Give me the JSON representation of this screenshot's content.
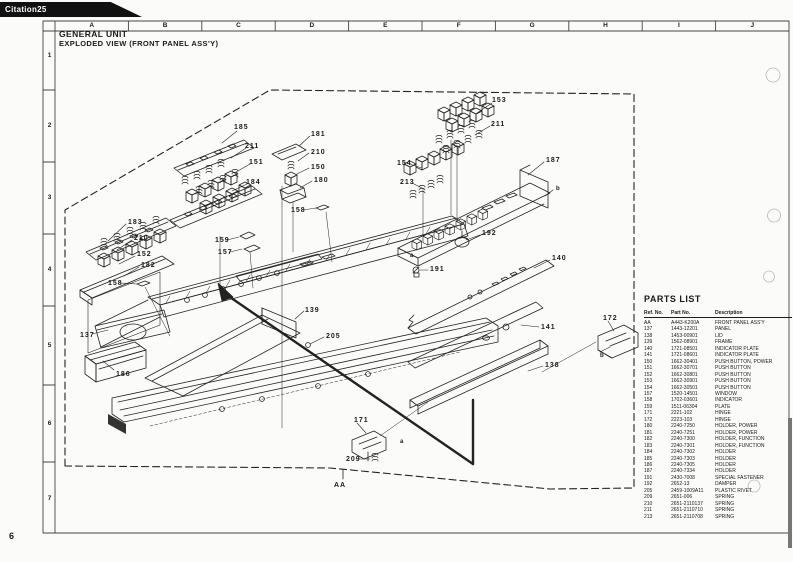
{
  "page": {
    "tab_label": "Citation25",
    "page_number": "6"
  },
  "title": {
    "line1": "GENERAL UNIT",
    "line2": "EXPLODED VIEW (FRONT PANEL ASS'Y)"
  },
  "grid": {
    "columns": [
      "A",
      "B",
      "C",
      "D",
      "E",
      "F",
      "G",
      "H",
      "I",
      "J"
    ],
    "rows": [
      "1",
      "2",
      "3",
      "4",
      "5",
      "6",
      "7"
    ]
  },
  "parts_list": {
    "title": "PARTS LIST",
    "headers": {
      "ref": "Ref. No.",
      "part": "Part No.",
      "desc": "Description"
    },
    "rows": [
      {
        "ref": "AA",
        "part": "A443-K200A",
        "desc": "FRONT PANEL ASS'Y"
      },
      {
        "ref": "137",
        "part": "1443-12201",
        "desc": "PANEL"
      },
      {
        "ref": "138",
        "part": "1453-00901",
        "desc": "LID"
      },
      {
        "ref": "139",
        "part": "1562-08901",
        "desc": "FRAME"
      },
      {
        "ref": "140",
        "part": "1721-08501",
        "desc": "INDICATOR PLATE"
      },
      {
        "ref": "141",
        "part": "1721-08601",
        "desc": "INDICATOR PLATE"
      },
      {
        "ref": "150",
        "part": "1662-30401",
        "desc": "PUSH BUTTON, POWER"
      },
      {
        "ref": "151",
        "part": "1662-30701",
        "desc": "PUSH BUTTON"
      },
      {
        "ref": "152",
        "part": "1662-30801",
        "desc": "PUSH BUTTON"
      },
      {
        "ref": "153",
        "part": "1662-30901",
        "desc": "PUSH BUTTON"
      },
      {
        "ref": "154",
        "part": "1662-30501",
        "desc": "PUSH BUTTON"
      },
      {
        "ref": "157",
        "part": "1520-14501",
        "desc": "WINDOW"
      },
      {
        "ref": "158",
        "part": "1702-03601",
        "desc": "INDICATOR"
      },
      {
        "ref": "159",
        "part": "1511-06304",
        "desc": "PLATE"
      },
      {
        "ref": "171",
        "part": "2221-102",
        "desc": "HINGE"
      },
      {
        "ref": "172",
        "part": "2223-103",
        "desc": "HINGE"
      },
      {
        "ref": "180",
        "part": "2240-7250",
        "desc": "HOLDER, POWER"
      },
      {
        "ref": "181",
        "part": "2240-7251",
        "desc": "HOLDER, POWER"
      },
      {
        "ref": "182",
        "part": "2240-7300",
        "desc": "HOLDER, FUNCTION"
      },
      {
        "ref": "183",
        "part": "2240-7301",
        "desc": "HOLDER, FUNCTION"
      },
      {
        "ref": "184",
        "part": "2240-7302",
        "desc": "HOLDER"
      },
      {
        "ref": "185",
        "part": "2240-7303",
        "desc": "HOLDER"
      },
      {
        "ref": "186",
        "part": "2240-7305",
        "desc": "HOLDER"
      },
      {
        "ref": "187",
        "part": "2240-7334",
        "desc": "HOLDER"
      },
      {
        "ref": "191",
        "part": "2430-7008",
        "desc": "SPECIAL FASTENER"
      },
      {
        "ref": "192",
        "part": "2652-13",
        "desc": "DAMPER"
      },
      {
        "ref": "205",
        "part": "2459-1009A11",
        "desc": "PLASTIC RIVET"
      },
      {
        "ref": "209",
        "part": "2651-006",
        "desc": "SPRING"
      },
      {
        "ref": "210",
        "part": "2651-2110137",
        "desc": "SPRING"
      },
      {
        "ref": "211",
        "part": "2651-2110710",
        "desc": "SPRING"
      },
      {
        "ref": "213",
        "part": "2651-2110708",
        "desc": "SPRING"
      }
    ]
  },
  "diagram": {
    "callouts": [
      {
        "label": "185",
        "x": 234,
        "y": 124
      },
      {
        "label": "211",
        "x": 245,
        "y": 143
      },
      {
        "label": "151",
        "x": 249,
        "y": 159
      },
      {
        "label": "184",
        "x": 246,
        "y": 179
      },
      {
        "label": "181",
        "x": 311,
        "y": 131
      },
      {
        "label": "210",
        "x": 311,
        "y": 149
      },
      {
        "label": "150",
        "x": 311,
        "y": 164
      },
      {
        "label": "180",
        "x": 314,
        "y": 177
      },
      {
        "label": "153",
        "x": 492,
        "y": 97
      },
      {
        "label": "211",
        "x": 491,
        "y": 121
      },
      {
        "label": "154",
        "x": 397,
        "y": 160
      },
      {
        "label": "213",
        "x": 400,
        "y": 179
      },
      {
        "label": "187",
        "x": 546,
        "y": 157
      },
      {
        "label": "b",
        "x": 556,
        "y": 186,
        "small": true
      },
      {
        "label": "a",
        "x": 410,
        "y": 253,
        "small": true
      },
      {
        "label": "192",
        "x": 482,
        "y": 230
      },
      {
        "label": "191",
        "x": 430,
        "y": 266
      },
      {
        "label": "140",
        "x": 552,
        "y": 255
      },
      {
        "label": "141",
        "x": 541,
        "y": 324
      },
      {
        "label": "138",
        "x": 545,
        "y": 362
      },
      {
        "label": "172",
        "x": 603,
        "y": 315
      },
      {
        "label": "b",
        "x": 600,
        "y": 353,
        "small": true
      },
      {
        "label": "183",
        "x": 128,
        "y": 219
      },
      {
        "label": "210",
        "x": 134,
        "y": 235
      },
      {
        "label": "152",
        "x": 137,
        "y": 251
      },
      {
        "label": "182",
        "x": 141,
        "y": 262
      },
      {
        "label": "158",
        "x": 108,
        "y": 280
      },
      {
        "label": "158",
        "x": 291,
        "y": 207
      },
      {
        "label": "159",
        "x": 215,
        "y": 237
      },
      {
        "label": "157",
        "x": 218,
        "y": 249
      },
      {
        "label": "137",
        "x": 80,
        "y": 332
      },
      {
        "label": "186",
        "x": 116,
        "y": 371
      },
      {
        "label": "139",
        "x": 305,
        "y": 307
      },
      {
        "label": "205",
        "x": 326,
        "y": 333
      },
      {
        "label": "171",
        "x": 354,
        "y": 417
      },
      {
        "label": "a",
        "x": 400,
        "y": 439,
        "small": true
      },
      {
        "label": "209",
        "x": 346,
        "y": 456
      },
      {
        "label": "AA",
        "x": 334,
        "y": 482
      }
    ]
  },
  "colors": {
    "ink": "#1a1a1a",
    "paper": "#fbfbf9",
    "tab_bg": "#111111"
  }
}
